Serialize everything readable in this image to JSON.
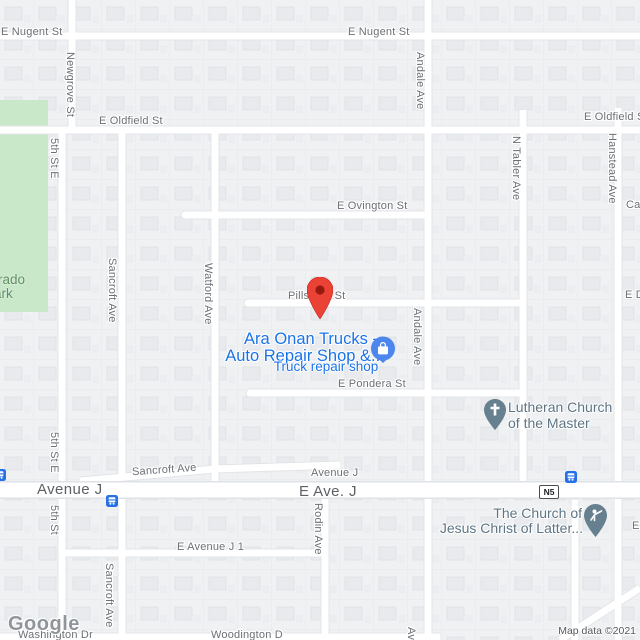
{
  "streets": {
    "nugent_left": "E Nugent St",
    "nugent_mid": "E Nugent St",
    "oldfield_left": "E Oldfield St",
    "oldfield_right": "E Oldfield St",
    "ovington": "E Ovington St",
    "pillsbury": "Pillsbury St",
    "pondera": "E Pondera St",
    "sancroft_h": "Sancroft Ave",
    "avenue_j_big": "Avenue J",
    "avenue_j_small": "Avenue J",
    "e_ave_j": "E Ave. J",
    "e_avenue_j1": "E Avenue J 1",
    "washington": "Washington Dr",
    "woodington": "Woodington D",
    "newgrove": "Newgrove St",
    "fifth_st_e_top": "5th St E",
    "fifth_st_e_mid": "5th St E",
    "fifth_st_bottom": "5th St",
    "sancroft_v_top": "Sancroft Ave",
    "sancroft_v_bottom": "Sancroft Ave",
    "watford": "Watford Ave",
    "andale_top": "Andale Ave",
    "andale_mid": "Andale Ave",
    "andale_bottom": "Ave",
    "n_tabler": "N Tabler Ave",
    "hanstead": "Hanstead Ave",
    "rodin": "Rodin Ave",
    "ca_fragment": "Ca",
    "ed_fragment": "E D",
    "e_fragment": "E"
  },
  "park": {
    "line1": "rado",
    "line2": "ark"
  },
  "pois": {
    "business": {
      "name_line1": "Ara Onan Trucks -",
      "name_line2": "Auto Repair Shop &...",
      "category": "Truck repair shop"
    },
    "lutheran": {
      "line1": "Lutheran Church",
      "line2": "of the Master"
    },
    "lds": {
      "line1": "The Church of",
      "line2": "Jesus Christ of Latter..."
    }
  },
  "transit": {
    "route_badge": "N5"
  },
  "attribution": {
    "logo": "Google",
    "text": "Map data ©2021"
  },
  "colors": {
    "business_text": "#1a73e8",
    "poi_icon_blue": "#4d87ee",
    "church_pin": "#66808f",
    "marker_red": "#ea4335",
    "park_green": "#c9e7c9",
    "transit_blue": "#2670e8",
    "road_white": "#ffffff",
    "land_gray": "#f2f3f5"
  }
}
